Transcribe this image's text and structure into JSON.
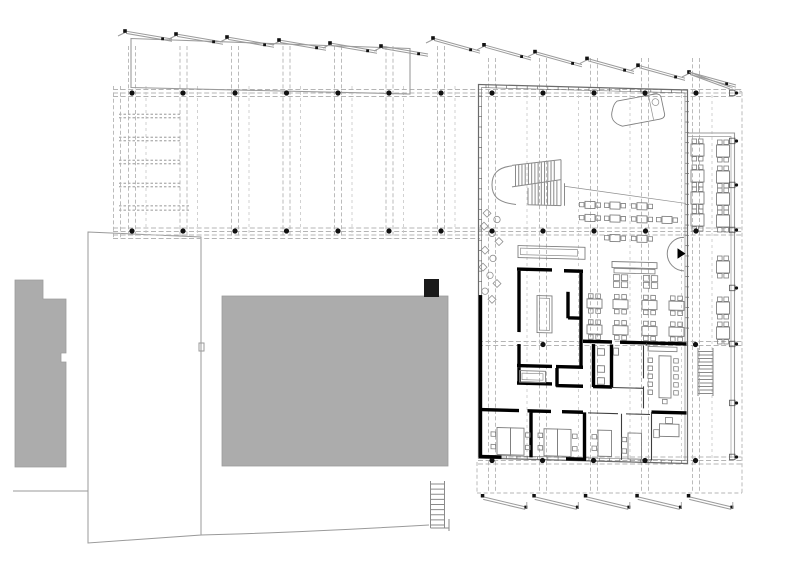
{
  "drawing": {
    "kind": "architectural floor plan with sawtooth roof, site massing and furnished interior",
    "background": "#ffffff"
  },
  "colors": {
    "massing_fill": "#acacac",
    "massing_stroke": "#9c9c9c",
    "site_line": "#9a9a9a",
    "outline": "#6b6b6b",
    "outline_light": "#8f8f8f",
    "wall": "#000000",
    "wall_thin": "#3d3d3d",
    "furniture": "#7f7f7f",
    "stair": "#8a8a8a",
    "roof_edge": "#9b9b9b",
    "dash": "#b4b4b4",
    "dash_light": "#c6c6c6",
    "dot": "#101010",
    "marker": "#111111"
  },
  "grid": {
    "canopy_axes_x": [
      132,
      183.5,
      235,
      286.5,
      338,
      389.5,
      441
    ],
    "building_axes_x": [
      492,
      543,
      594,
      645,
      696
    ],
    "mid_lines_canopy_x": [
      146,
      197.5,
      249,
      300.5,
      352,
      403.5,
      455
    ],
    "mid_lines_building_x": [
      527,
      578.5,
      630,
      681.5,
      712
    ],
    "edge_lines_x": [
      113.5,
      120.5
    ],
    "row1_ys": [
      89.5,
      93,
      96.5
    ],
    "row2_ys": [
      228,
      231.5,
      235
    ],
    "row2_apron_y": 238.5,
    "row3_ys": [
      341.5,
      345.5
    ],
    "row4_ys": [
      457,
      460.5,
      464
    ],
    "south_apron_y": 493,
    "dots": [
      {
        "y": 93,
        "xs": [
          132,
          183,
          235,
          286.5,
          338,
          389,
          441,
          492,
          543,
          594,
          645,
          696
        ]
      },
      {
        "y": 231,
        "xs": [
          132,
          183,
          235,
          286.5,
          338,
          389,
          441,
          492,
          543,
          594,
          645.5,
          696
        ]
      },
      {
        "y": 344.5,
        "xs": [
          543,
          695.5
        ]
      },
      {
        "y": 460.5,
        "xs": [
          492,
          542.5,
          593.5,
          645,
          695.5
        ]
      }
    ],
    "ladder_rungs_y": [
      116,
      139,
      162,
      185,
      208
    ],
    "terrace_marker_y": [
      93,
      141,
      185,
      230,
      288,
      344,
      403,
      457
    ]
  },
  "roof": {
    "north_teeth_x": [
      125,
      176,
      227,
      279,
      330,
      381,
      433,
      484,
      535,
      587,
      638,
      689
    ],
    "north_teeth_y": [
      31,
      34,
      37,
      40,
      43,
      46,
      38,
      44.8,
      51.6,
      58.4,
      65.2,
      72
    ],
    "north_teeth_drop": [
      8,
      8,
      8,
      8,
      8,
      8,
      13,
      13,
      13,
      13,
      13,
      13
    ],
    "north_run": 47,
    "tail": {
      "x1": 689,
      "y1": 72,
      "x2": 730,
      "y2": 87,
      "x3": 742,
      "y3": 92
    },
    "south_teeth_x": [
      482,
      533.5,
      585,
      636.5,
      688
    ],
    "south_y": 494,
    "south_drop": 10,
    "south_run": 44
  },
  "furniture": {
    "cafe_rows": [
      {
        "y": 198.5,
        "xs": [
          585,
          610,
          637
        ]
      },
      {
        "y": 211.5,
        "xs": [
          585,
          610,
          637,
          662
        ]
      },
      {
        "y": 231,
        "xs": [
          610,
          637
        ]
      }
    ],
    "long_table": {
      "x": 612,
      "y": 258,
      "w": 45,
      "stool_xs": [
        613.5,
        621.5,
        643.5,
        651.5
      ],
      "stool_ys": [
        271,
        278
      ]
    },
    "hall_tables": {
      "cols": [
        587,
        613,
        642,
        669
      ],
      "rows": [
        296,
        322
      ]
    },
    "terrace_tables": {
      "left_x": 691,
      "right_x": 716.5,
      "left_ys": [
        144,
        170,
        192,
        214
      ],
      "right_ys": [
        145,
        171,
        193,
        215,
        261,
        302,
        327
      ]
    },
    "scatter_seats": [
      {
        "t": "d",
        "x": 487,
        "y": 213
      },
      {
        "t": "c",
        "x": 497,
        "y": 219
      },
      {
        "t": "d",
        "x": 484,
        "y": 226
      },
      {
        "t": "c",
        "x": 492,
        "y": 233
      },
      {
        "t": "d",
        "x": 499,
        "y": 241
      },
      {
        "t": "d",
        "x": 485,
        "y": 250
      },
      {
        "t": "c",
        "x": 493,
        "y": 258
      },
      {
        "t": "d",
        "x": 483,
        "y": 267
      },
      {
        "t": "c",
        "x": 490,
        "y": 275
      },
      {
        "t": "d",
        "x": 497,
        "y": 283
      },
      {
        "t": "c",
        "x": 485,
        "y": 291
      },
      {
        "t": "d",
        "x": 492,
        "y": 299
      }
    ],
    "office_desk_pairs": [
      {
        "x": 497,
        "y": 427
      },
      {
        "x": 544,
        "y": 427
      }
    ],
    "office_single_desks": [
      {
        "x": 598,
        "y": 427
      },
      {
        "x": 628,
        "y": 429
      }
    ],
    "office_corner_desk": {
      "x": 659.5,
      "y": 419
    },
    "meeting": {
      "table_x": 659,
      "table_y": 351,
      "table_w": 12,
      "table_h": 42,
      "chair_ys": [
        353.5,
        361.5,
        369.5,
        377.5,
        385.5
      ],
      "left_x": 652.5,
      "right_x": 672.5,
      "end_chair_x": 662.5,
      "end_chair_y": 394.5,
      "sideboard_x": 648,
      "sideboard_y": 342,
      "sideboard_w": 29
    }
  },
  "stairs": {
    "main_top_treads": 13,
    "main_bottom_treads": 9,
    "east": {
      "x1": 698,
      "x2": 713,
      "y1": 348,
      "y2": 396,
      "treads": 13
    },
    "site": {
      "x1": 430.5,
      "x2": 444.5,
      "y1": 481,
      "y2": 528,
      "treads": 9
    }
  },
  "wall_ticks": {
    "step": 10.3,
    "top_x": [
      486,
      682
    ],
    "east_y": [
      96,
      332
    ],
    "west_y": [
      96,
      290
    ],
    "bottom_x": [
      486,
      690
    ]
  }
}
